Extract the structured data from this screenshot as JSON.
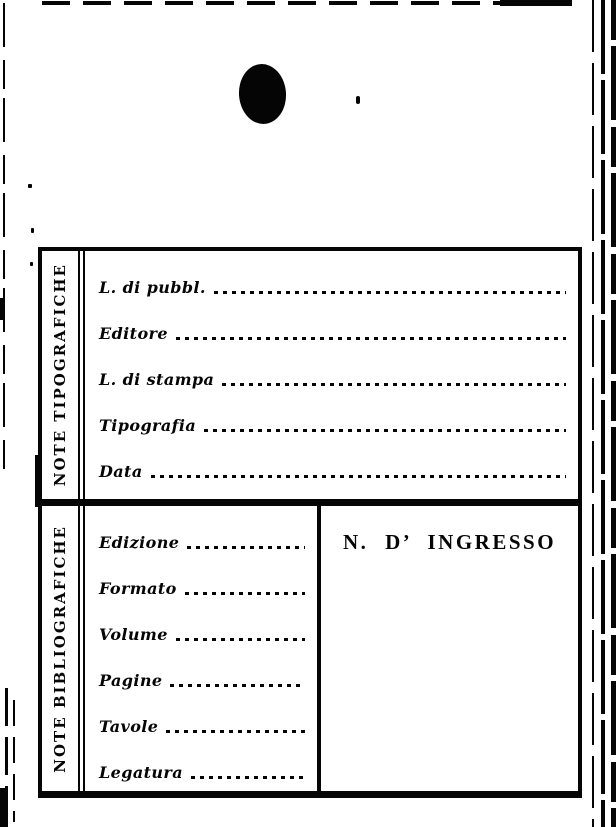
{
  "colors": {
    "ink": "#050505",
    "paper": "#ffffff"
  },
  "sections": {
    "tipografiche": {
      "title": "NOTE TIPOGRAFICHE",
      "fields": [
        "L. di pubbl.",
        "Editore",
        "L. di stampa",
        "Tipografia",
        "Data"
      ]
    },
    "bibliografiche": {
      "title": "NOTE BIBLIOGRAFICHE",
      "fields": [
        "Edizione",
        "Formato",
        "Volume",
        "Pagine",
        "Tavole",
        "Legatura"
      ],
      "ingresso": "N. D’ INGRESSO"
    }
  }
}
